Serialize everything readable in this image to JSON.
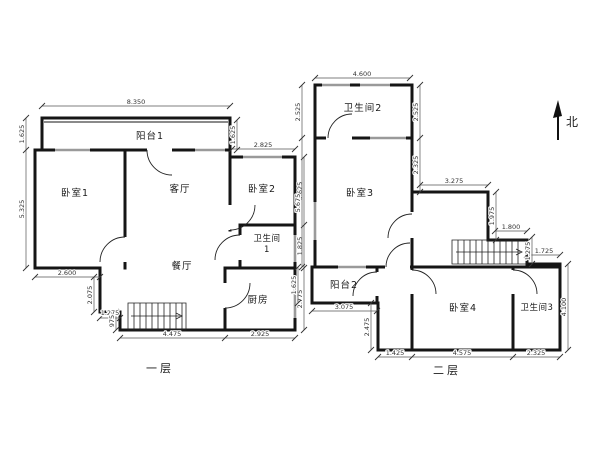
{
  "page": {
    "background": "#ffffff"
  },
  "north": {
    "label": "北"
  },
  "floor1": {
    "title": "一层",
    "rooms": {
      "balcony1": "阳台1",
      "bedroom1": "卧室1",
      "living": "客厅",
      "bedroom2": "卧室2",
      "bath1_line1": "卫生间",
      "bath1_line2": "1",
      "dining": "餐厅",
      "kitchen": "厨房"
    },
    "dims": {
      "top": "8.350",
      "balcony_left": "1.625",
      "left": "5.325",
      "balcony_right": "1.625",
      "bed2_top": "2.825",
      "bl_w": "2.600",
      "bl_h": "2.075",
      "bl_w2": "1.275",
      "bl_h2": "975",
      "bottom_left": "4.475",
      "bottom_right": "2.925",
      "right_top": "3.625",
      "right_mid": "1.825",
      "right_bottom": "2.775"
    }
  },
  "floor2": {
    "title": "二层",
    "rooms": {
      "bath2": "卫生间2",
      "bedroom3": "卧室3",
      "balcony2": "阳台2",
      "bedroom4": "卧室4",
      "bath3": "卫生间3"
    },
    "dims": {
      "top": "4.600",
      "left_top": "2.525",
      "left_mid": "5.675",
      "left_balcony": "1.625",
      "balcony_w": "3.075",
      "step_h": "2.475",
      "bottom_1": "1.425",
      "bottom_2": "4.575",
      "bottom_3": "2.325",
      "inner_right_top": "2.525",
      "inner_right_mid": "2.325",
      "corridor_w": "3.275",
      "corridor_h": "1.975",
      "stair_w": "1.800",
      "stair_h": "1.275",
      "wing_top": "1.725",
      "right": "4.100"
    }
  }
}
